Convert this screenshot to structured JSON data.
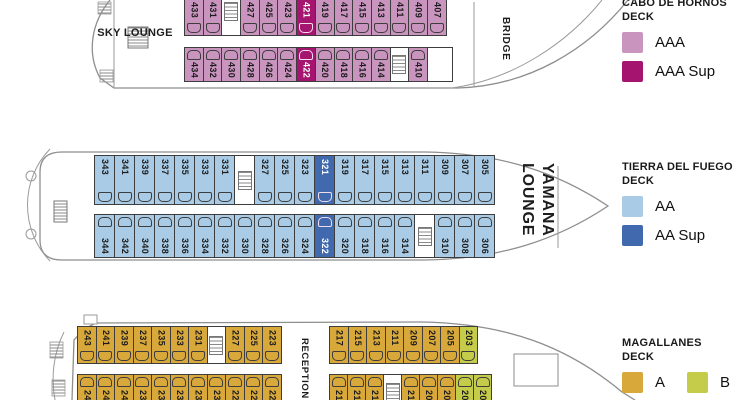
{
  "legend": {
    "panels": [
      {
        "title_line1": "CABO DE HORNOS",
        "title_line2": "DECK",
        "entries": [
          {
            "label": "AAA",
            "color": "#c994be"
          },
          {
            "label": "AAA Sup",
            "color": "#a51570"
          }
        ]
      },
      {
        "title_line1": "TIERRA DEL FUEGO",
        "title_line2": "DECK",
        "entries": [
          {
            "label": "AA",
            "color": "#a9cbe5"
          },
          {
            "label": "AA Sup",
            "color": "#4069ae"
          }
        ]
      },
      {
        "title_line1": "MAGALLANES",
        "title_line2": "DECK",
        "entries": [
          {
            "label": "A",
            "color": "#d8a83b"
          },
          {
            "label": "B",
            "color": "#c5cc4a"
          }
        ]
      }
    ]
  },
  "decks": [
    {
      "id": "cabo-de-hornos",
      "area_labels": {
        "sky_lounge": "SKY LOUNGE",
        "bridge": "BRIDGE"
      },
      "colors": {
        "std": "#c994be",
        "sup": "#a51570"
      },
      "rows": [
        {
          "cells": [
            {
              "n": "433"
            },
            {
              "n": "431"
            },
            {
              "t": "stairs"
            },
            {
              "n": "427"
            },
            {
              "n": "425"
            },
            {
              "n": "423"
            },
            {
              "n": "421",
              "t": "sup"
            },
            {
              "n": "419"
            },
            {
              "n": "417"
            },
            {
              "n": "415"
            },
            {
              "n": "413"
            },
            {
              "n": "411"
            },
            {
              "n": "409"
            },
            {
              "n": "407"
            }
          ]
        },
        {
          "cells": [
            {
              "n": "434"
            },
            {
              "n": "432"
            },
            {
              "n": "430"
            },
            {
              "n": "428"
            },
            {
              "n": "426"
            },
            {
              "n": "424"
            },
            {
              "n": "422",
              "t": "sup"
            },
            {
              "n": "420"
            },
            {
              "n": "418"
            },
            {
              "n": "416"
            },
            {
              "n": "414"
            },
            {
              "t": "stairs"
            },
            {
              "n": "410"
            },
            {
              "t": "blank",
              "w": 26
            }
          ]
        }
      ]
    },
    {
      "id": "tierra-del-fuego",
      "area_labels": {
        "lounge_line1": "YAMANA",
        "lounge_line2": "LOUNGE"
      },
      "colors": {
        "std": "#a9cbe5",
        "sup": "#4069ae"
      },
      "rows": [
        {
          "cells": [
            {
              "n": "343"
            },
            {
              "n": "341"
            },
            {
              "n": "339"
            },
            {
              "n": "337"
            },
            {
              "n": "335"
            },
            {
              "n": "333"
            },
            {
              "n": "331"
            },
            {
              "t": "stairs"
            },
            {
              "n": "327"
            },
            {
              "n": "325"
            },
            {
              "n": "323"
            },
            {
              "n": "321",
              "t": "sup"
            },
            {
              "n": "319"
            },
            {
              "n": "317"
            },
            {
              "n": "315"
            },
            {
              "n": "313"
            },
            {
              "n": "311"
            },
            {
              "n": "309"
            },
            {
              "n": "307"
            },
            {
              "n": "305"
            }
          ]
        },
        {
          "cells": [
            {
              "n": "344"
            },
            {
              "n": "342"
            },
            {
              "n": "340"
            },
            {
              "n": "338"
            },
            {
              "n": "336"
            },
            {
              "n": "334"
            },
            {
              "n": "332"
            },
            {
              "n": "330"
            },
            {
              "n": "328"
            },
            {
              "n": "326"
            },
            {
              "n": "324"
            },
            {
              "n": "322",
              "t": "sup"
            },
            {
              "n": "320"
            },
            {
              "n": "318"
            },
            {
              "n": "316"
            },
            {
              "n": "314"
            },
            {
              "t": "stairs"
            },
            {
              "n": "310"
            },
            {
              "n": "308"
            },
            {
              "n": "306"
            }
          ]
        }
      ]
    },
    {
      "id": "magallanes",
      "area_labels": {
        "reception": "RECEPTION"
      },
      "colors": {
        "std": "#d8a83b",
        "alt": "#c5cc4a"
      },
      "rows": [
        {
          "cells": [
            {
              "n": "243"
            },
            {
              "n": "241"
            },
            {
              "n": "239"
            },
            {
              "n": "237"
            },
            {
              "n": "235"
            },
            {
              "n": "233"
            },
            {
              "n": "231"
            },
            {
              "t": "stairs"
            },
            {
              "n": "227"
            },
            {
              "n": "225"
            },
            {
              "n": "223"
            }
          ]
        },
        {
          "cells": [
            {
              "n": "217"
            },
            {
              "n": "215"
            },
            {
              "n": "213"
            },
            {
              "n": "211"
            },
            {
              "n": "209"
            },
            {
              "n": "207"
            },
            {
              "n": "205"
            },
            {
              "n": "203",
              "t": "alt"
            }
          ]
        },
        {
          "cells": [
            {
              "n": "244"
            },
            {
              "n": "242"
            },
            {
              "n": "240"
            },
            {
              "n": "238"
            },
            {
              "n": "236"
            },
            {
              "n": "234"
            },
            {
              "n": "232"
            },
            {
              "n": "230"
            },
            {
              "n": "228"
            },
            {
              "n": "226"
            },
            {
              "n": "224"
            }
          ]
        },
        {
          "cells": [
            {
              "n": "216"
            },
            {
              "n": "214"
            },
            {
              "n": "212"
            },
            {
              "t": "stairs"
            },
            {
              "n": "210"
            },
            {
              "n": "208"
            },
            {
              "n": "206"
            },
            {
              "n": "204",
              "t": "alt"
            },
            {
              "n": "202",
              "t": "alt"
            }
          ]
        }
      ]
    }
  ]
}
